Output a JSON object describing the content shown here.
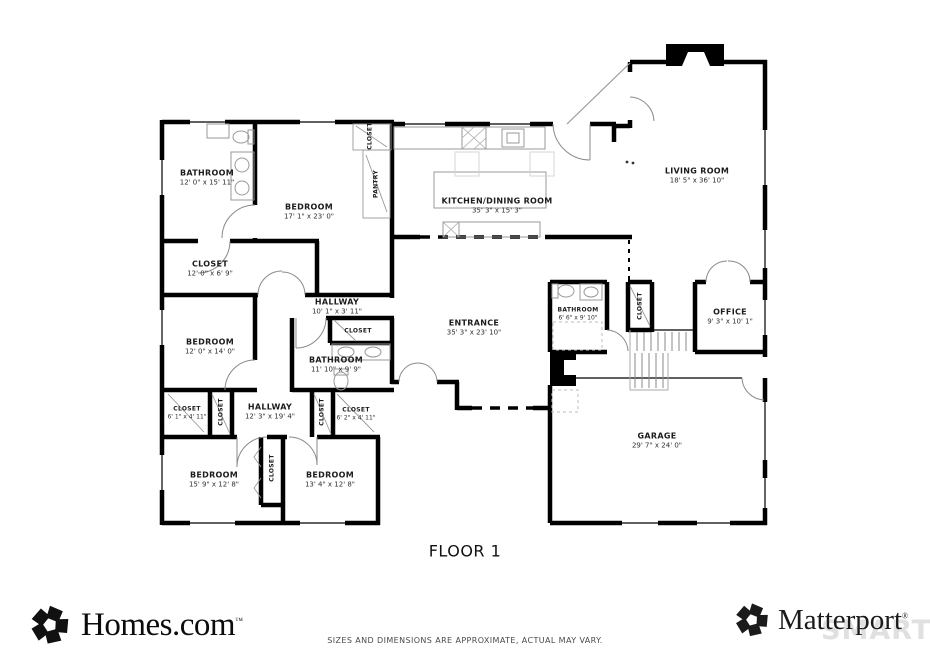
{
  "page": {
    "floor_label": "FLOOR 1"
  },
  "rooms": [
    {
      "name": "BATHROOM",
      "dims": "12' 0\" x 15' 11\"",
      "x": 207,
      "y": 178
    },
    {
      "name": "BEDROOM",
      "dims": "17' 1\" x 23' 0\"",
      "x": 309,
      "y": 212
    },
    {
      "name": "CLOSET",
      "dims": "12' 0\" x 6' 9\"",
      "x": 210,
      "y": 269
    },
    {
      "name": "CLOSET",
      "x": 370,
      "y": 136,
      "vertical": true,
      "small": true
    },
    {
      "name": "PANTRY",
      "x": 376,
      "y": 184,
      "vertical": true,
      "small": true
    },
    {
      "name": "KITCHEN/DINING ROOM",
      "dims": "35' 3\" x 15' 3\"",
      "x": 497,
      "y": 206
    },
    {
      "name": "LIVING ROOM",
      "dims": "18' 5\" x 36' 10\"",
      "x": 697,
      "y": 176
    },
    {
      "name": "HALLWAY",
      "dims": "10' 1\" x 3' 11\"",
      "x": 337,
      "y": 307
    },
    {
      "name": "CLOSET",
      "x": 358,
      "y": 331,
      "small": true
    },
    {
      "name": "BATHROOM",
      "dims": "11' 10\" x 9' 9\"",
      "x": 336,
      "y": 365
    },
    {
      "name": "ENTRANCE",
      "dims": "35' 3\" x 23' 10\"",
      "x": 474,
      "y": 328
    },
    {
      "name": "BATHROOM",
      "dims": "6' 6\" x 9' 10\"",
      "x": 578,
      "y": 314,
      "small": true
    },
    {
      "name": "CLOSET",
      "x": 640,
      "y": 306,
      "vertical": true,
      "small": true
    },
    {
      "name": "OFFICE",
      "dims": "9' 3\" x 10' 1\"",
      "x": 730,
      "y": 317
    },
    {
      "name": "BEDROOM",
      "dims": "12' 0\" x 14' 0\"",
      "x": 210,
      "y": 347
    },
    {
      "name": "CLOSET",
      "dims": "6' 1\" x 4' 11\"",
      "x": 187,
      "y": 413,
      "small": true
    },
    {
      "name": "CLOSET",
      "x": 221,
      "y": 412,
      "vertical": true,
      "small": true
    },
    {
      "name": "HALLWAY",
      "dims": "12' 3\" x 19' 4\"",
      "x": 270,
      "y": 412
    },
    {
      "name": "CLOSET",
      "x": 322,
      "y": 412,
      "vertical": true,
      "small": true
    },
    {
      "name": "CLOSET",
      "dims": "6' 2\" x 4' 11\"",
      "x": 356,
      "y": 414,
      "small": true
    },
    {
      "name": "BEDROOM",
      "dims": "15' 9\" x 12' 8\"",
      "x": 214,
      "y": 480
    },
    {
      "name": "CLOSET",
      "x": 272,
      "y": 468,
      "vertical": true,
      "small": true
    },
    {
      "name": "BEDROOM",
      "dims": "13' 4\" x 12' 8\"",
      "x": 330,
      "y": 480
    },
    {
      "name": "GARAGE",
      "dims": "29' 7\" x 24' 0\"",
      "x": 657,
      "y": 441
    }
  ],
  "footer": {
    "homes_text": "Homes.com",
    "homes_tm": "™",
    "matterport_text": "Matterport",
    "matterport_reg": "®",
    "watermark_text": "SMART",
    "watermark_boxes": [
      "M",
      "L",
      "S"
    ],
    "disclaimer": "SIZES AND DIMENSIONS ARE APPROXIMATE, ACTUAL MAY VARY.",
    "logo_color": "#111111"
  }
}
